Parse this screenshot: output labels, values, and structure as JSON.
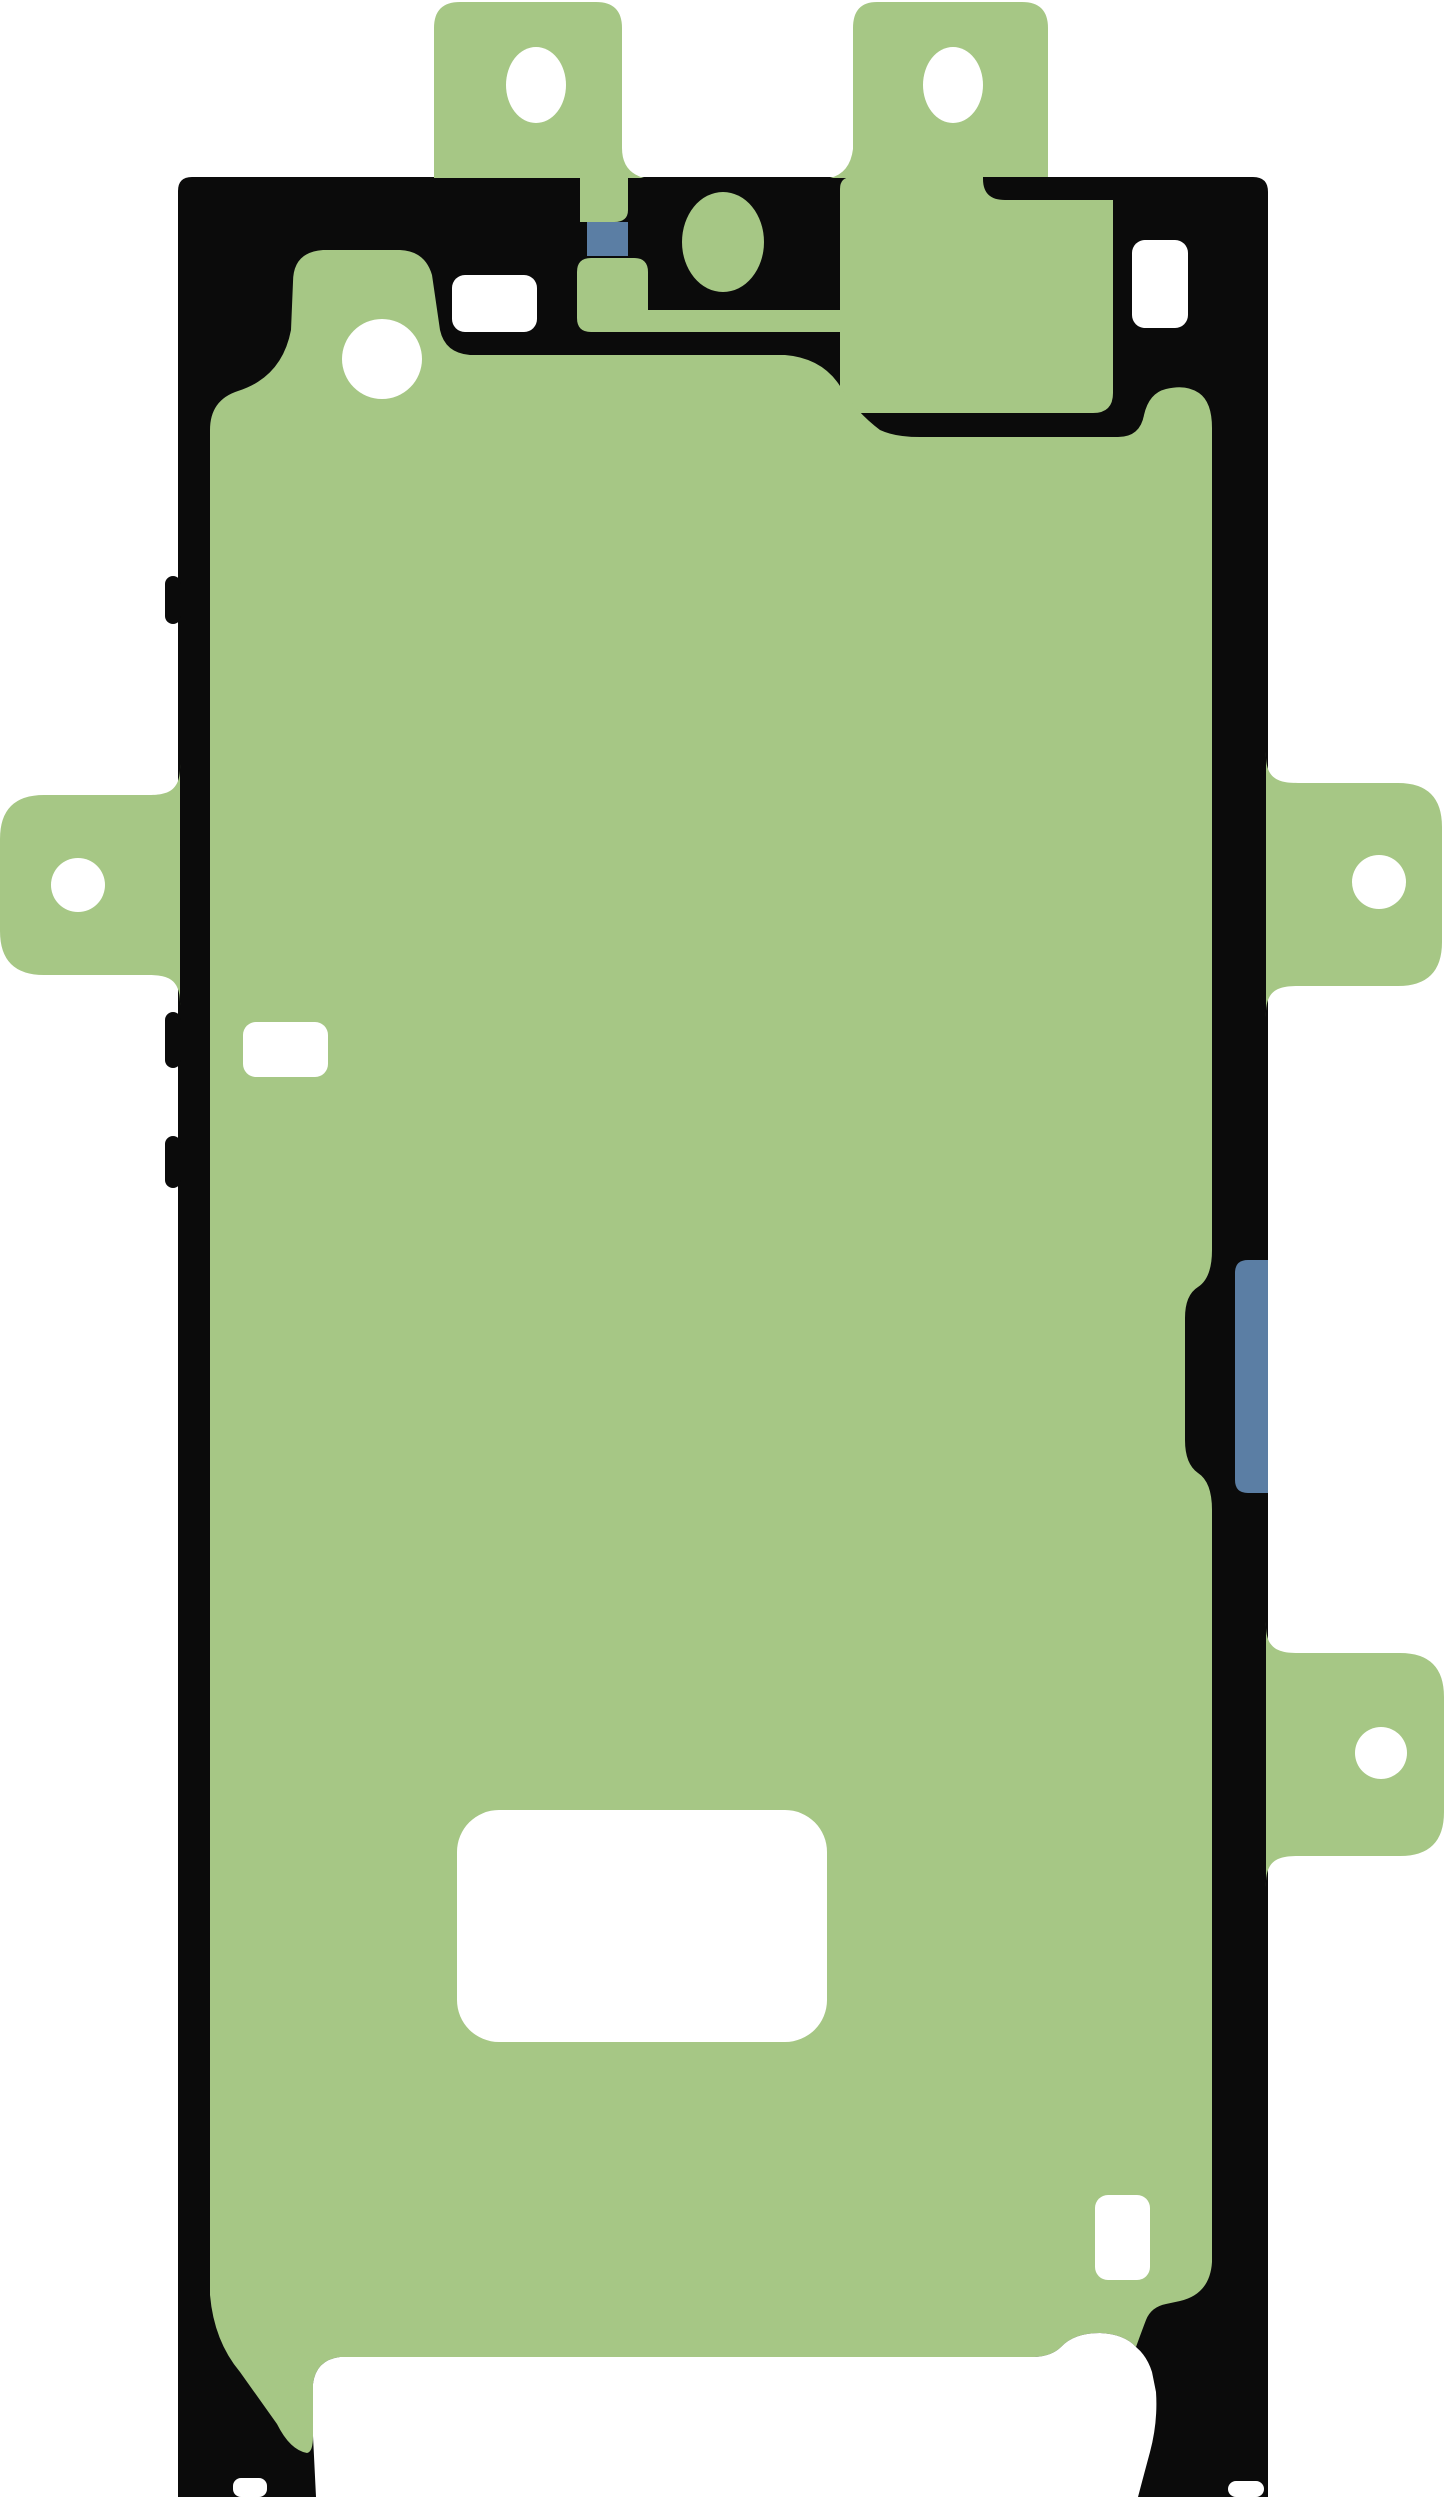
{
  "meta": {
    "description": "Product illustration of a smartphone display adhesive sticker (green adhesive film with black gasket outline, alignment tabs and cutouts)",
    "width_px": 1445,
    "height_px": 2497
  },
  "colors": {
    "background": "#ffffff",
    "outline_black": "#0b0b0b",
    "adhesive_green": "#a6c785",
    "accent_blue": "#5b7ea4",
    "cutout_white": "#ffffff"
  },
  "parts": {
    "body": "adhesive-body-gasket",
    "tabs": [
      "top-left-pull-tab",
      "top-right-pull-tab",
      "left-side-pull-tab",
      "right-upper-pull-tab",
      "right-lower-pull-tab"
    ],
    "holes": [
      "top-left-tab-oval-hole",
      "top-right-tab-oval-hole",
      "left-tab-round-hole",
      "right-upper-tab-round-hole",
      "right-lower-tab-round-hole",
      "front-camera-cutout",
      "sensor-circle-cutout",
      "top-left-rect-cutout",
      "top-right-rect-cutout",
      "left-mid-rect-cutout",
      "bottom-large-rect-cutout",
      "bottom-right-small-rect-cutout",
      "bottom-speaker-cutout"
    ],
    "accents": [
      "blue-square-marker",
      "blue-side-rect-marker"
    ]
  }
}
